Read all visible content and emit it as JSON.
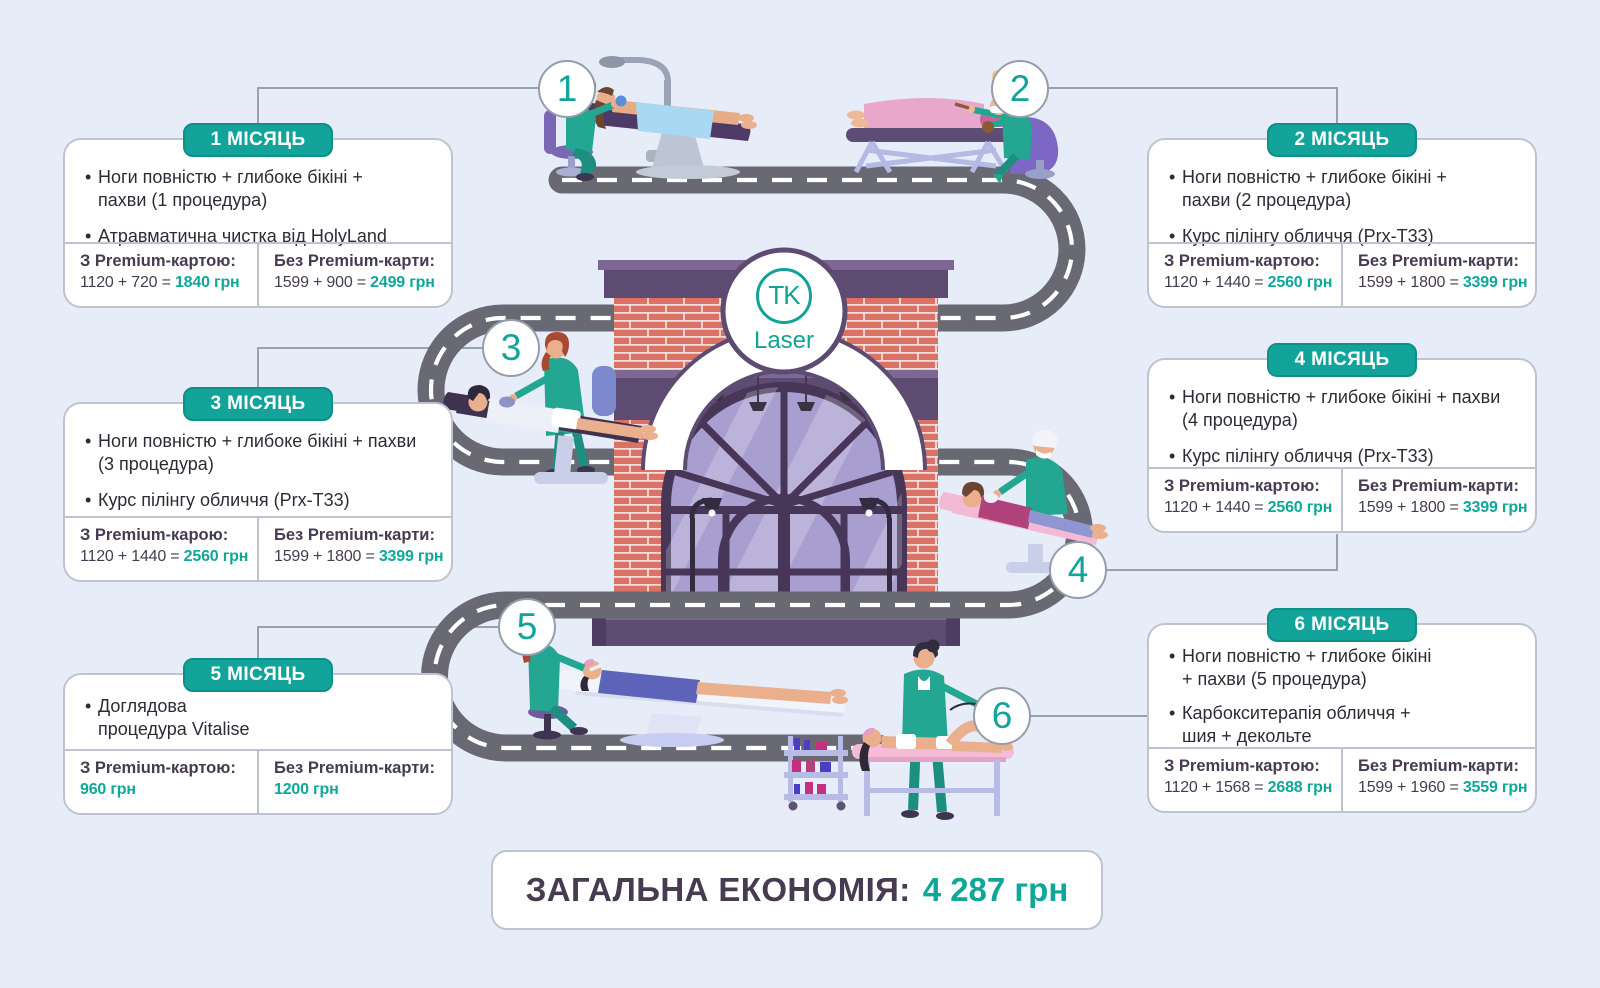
{
  "brand": {
    "logo_top": "TK",
    "logo_bottom": "Laser"
  },
  "months": [
    {
      "number": "1",
      "label": "1 МІСЯЦЬ",
      "items": [
        "Ноги повністю + глибоке бікіні +\nпахви (1 процедура)",
        "Атравматична чистка від HolyLand"
      ],
      "with_card": {
        "label": "З Premium-картою:",
        "calc": "1120 + 720 = ",
        "total": "1840 грн"
      },
      "without_card": {
        "label": "Без Premium-карти:",
        "calc": "1599 + 900 = ",
        "total": "2499 грн"
      }
    },
    {
      "number": "2",
      "label": "2 МІСЯЦЬ",
      "items": [
        "Ноги повністю + глибоке бікіні +\nпахви (2 процедура)",
        "Курс пілінгу обличчя (Prx-T33)"
      ],
      "with_card": {
        "label": "З Premium-картою:",
        "calc": "1120 + 1440 = ",
        "total": "2560 грн"
      },
      "without_card": {
        "label": "Без Premium-карти:",
        "calc": "1599 + 1800 = ",
        "total": "3399 грн"
      }
    },
    {
      "number": "3",
      "label": "3 МІСЯЦЬ",
      "items": [
        "Ноги повністю + глибоке бікіні + пахви\n(3 процедура)",
        "Курс пілінгу обличчя (Prx-T33)"
      ],
      "with_card": {
        "label": "З Premium-карою:",
        "calc": "1120 + 1440 = ",
        "total": "2560 грн"
      },
      "without_card": {
        "label": "Без Premium-карти:",
        "calc": "1599 + 1800 = ",
        "total": "3399 грн"
      }
    },
    {
      "number": "4",
      "label": "4 МІСЯЦЬ",
      "items": [
        "Ноги повністю + глибоке бікіні + пахви\n(4 процедура)",
        "Курс пілінгу обличчя (Prx-T33)"
      ],
      "with_card": {
        "label": "З Premium-картою:",
        "calc": "1120 + 1440 = ",
        "total": "2560 грн"
      },
      "without_card": {
        "label": "Без Premium-карти:",
        "calc": "1599 + 1800 = ",
        "total": "3399 грн"
      }
    },
    {
      "number": "5",
      "label": "5 МІСЯЦЬ",
      "items": [
        "Доглядова\nпроцедура Vitalise"
      ],
      "with_card": {
        "label": "З Premium-картою:",
        "calc": "",
        "total": "960 грн"
      },
      "without_card": {
        "label": "Без Premium-карти:",
        "calc": "",
        "total": "1200 грн"
      }
    },
    {
      "number": "6",
      "label": "6 МІСЯЦЬ",
      "items": [
        "Ноги повністю + глибоке бікіні\n+ пахви (5 процедура)",
        "Карбокситерапія обличчя +\nшия + декольте"
      ],
      "with_card": {
        "label": "З Premium-картою:",
        "calc": "1120 + 1568 = ",
        "total": "2688 грн"
      },
      "without_card": {
        "label": "Без Premium-карти:",
        "calc": "1599 + 1960 = ",
        "total": "3559 грн"
      }
    }
  ],
  "total_banner": {
    "label": "ЗАГАЛЬНА ЕКОНОМІЯ:",
    "value": "4 287 грн"
  },
  "colors": {
    "accent_teal": "#12a49a",
    "text_dark": "#473b52",
    "road_gray": "#696973",
    "background": "#e7edf8",
    "brick": "#dc7166",
    "purple_trim": "#5e4b72"
  }
}
